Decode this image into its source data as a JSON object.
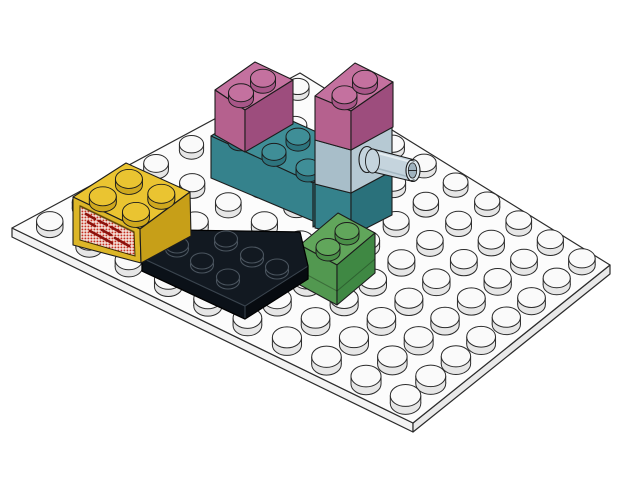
{
  "scene": {
    "description": "3D render of LEGO bricks assembled on a white stud plate",
    "background": "#ffffff",
    "edge_color": "#1c1c1c"
  },
  "baseplate": {
    "label": "white plate 10x8 studs",
    "studs_cols": 10,
    "studs_rows": 8,
    "colors": {
      "top": "#fcfcfc",
      "side_left": "#f3f3f3",
      "side_right": "#e9e9e9",
      "stud_top": "#fafafa",
      "stud_side": "#e6e6e6",
      "edge": "#2b2b2b"
    }
  },
  "parts": [
    {
      "id": "teal-brick-2x3",
      "label": "teal 2x3 brick, 4 studs exposed",
      "colors": {
        "top": "#3f8e97",
        "left": "#35828c",
        "right": "#2a717b",
        "stud_side": "#2d747e"
      }
    },
    {
      "id": "pink-brick-left",
      "label": "dark pink 1x2 brick on teal brick",
      "colors": {
        "top": "#c4719f",
        "left": "#b5618e",
        "right": "#9d4d7d",
        "stud_side": "#a85688"
      }
    },
    {
      "id": "column-teal-brick-1x2",
      "label": "teal 1x2 brick at base of right column",
      "colors": {
        "left": "#35828c",
        "right": "#2a717b"
      }
    },
    {
      "id": "lightblue-pin-brick",
      "label": "light blue 1x2 brick with side pin",
      "colors": {
        "left": "#a8bec9",
        "right": "#b6c9d3",
        "pin": "#c5d4dd",
        "pin_light": "#dde8ee",
        "pin_hole": "#9fb3bf",
        "pin_hi": "#ecf3f6",
        "pin_lo": "#8fa5b1"
      }
    },
    {
      "id": "pink-brick-right",
      "label": "dark pink 1x2 brick on pin brick",
      "colors": {
        "top": "#c4719f",
        "left": "#b5618e",
        "right": "#9d4d7d",
        "stud_side": "#a85688"
      }
    },
    {
      "id": "green-brick-1x2",
      "label": "green 1x2 brick",
      "colors": {
        "top": "#61a65b",
        "left": "#529850",
        "right": "#3f8843",
        "stud_side": "#4a8f48"
      }
    },
    {
      "id": "black-wedge-plate-3x3",
      "label": "black 3x3 cut-corner wedge plate, 6 studs",
      "colors": {
        "top": "#121921",
        "left": "#0b1118",
        "right": "#070b10",
        "edge": "#3a444e",
        "stud_edge": "#4a545e"
      }
    },
    {
      "id": "yellow-grille-brick-2x2",
      "label": "yellow 2x2 brick with red grille panel",
      "colors": {
        "top": "#eac431",
        "left": "#dcb628",
        "right": "#c79f18",
        "stud_side": "#cfa81e",
        "grille_dot": "#c53022",
        "grille_bg": "#f3ded6",
        "grille_dark": "#8c120c",
        "frame_shadow": "#6b500d"
      }
    }
  ]
}
